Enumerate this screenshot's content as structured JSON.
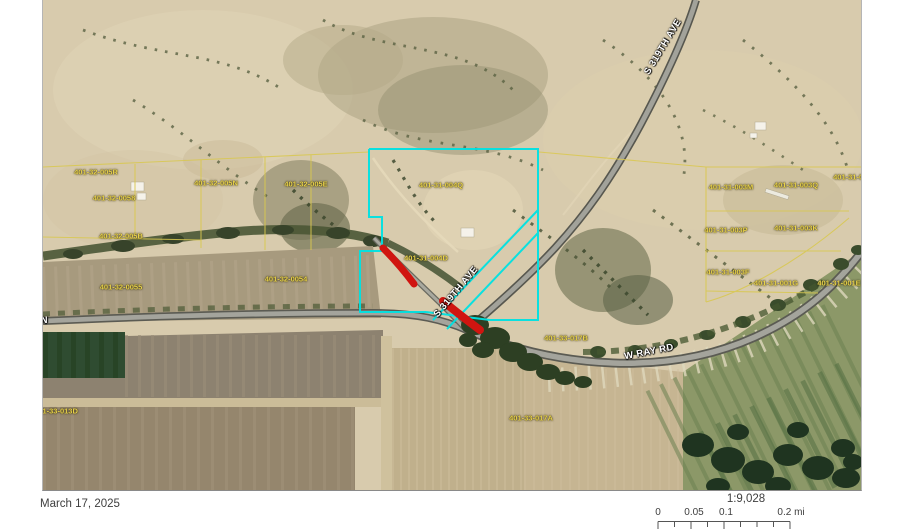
{
  "map": {
    "parcel_labels": [
      {
        "text": "401-32-005R"
      },
      {
        "text": "401-32-0058"
      },
      {
        "text": "401-32-005B"
      },
      {
        "text": "401-32-005N"
      },
      {
        "text": "401-32-005E"
      },
      {
        "text": "401-31-004Q"
      },
      {
        "text": "401-31-004D"
      },
      {
        "text": "401-32-0054"
      },
      {
        "text": "401-32-0055"
      },
      {
        "text": "401-31-003M"
      },
      {
        "text": "401-31-003Q"
      },
      {
        "text": "401-31-003D"
      },
      {
        "text": "401-31-003P"
      },
      {
        "text": "401-31-003K"
      },
      {
        "text": "401-31-003F"
      },
      {
        "text": "401-31-001G"
      },
      {
        "text": "401-31-001E"
      },
      {
        "text": "401-33-017B"
      },
      {
        "text": "401-33-017A"
      },
      {
        "text": "401-33-013D"
      }
    ],
    "road_labels": {
      "s319_upper": "S 319TH AVE",
      "s319_lower": "S 319TH AVE",
      "w_ray": "W RAY RD",
      "n_edge": "N"
    },
    "colors": {
      "selected_parcel": "#00e2e2",
      "highlight_segment": "#d01510",
      "parcel_line": "#d9c84f"
    }
  },
  "footer": {
    "date": "March 17, 2025",
    "scale_ratio": "1:9,028",
    "scale_bar": {
      "tick_labels": [
        "0",
        "0.05",
        "0.1",
        "0.2 mi"
      ]
    }
  }
}
